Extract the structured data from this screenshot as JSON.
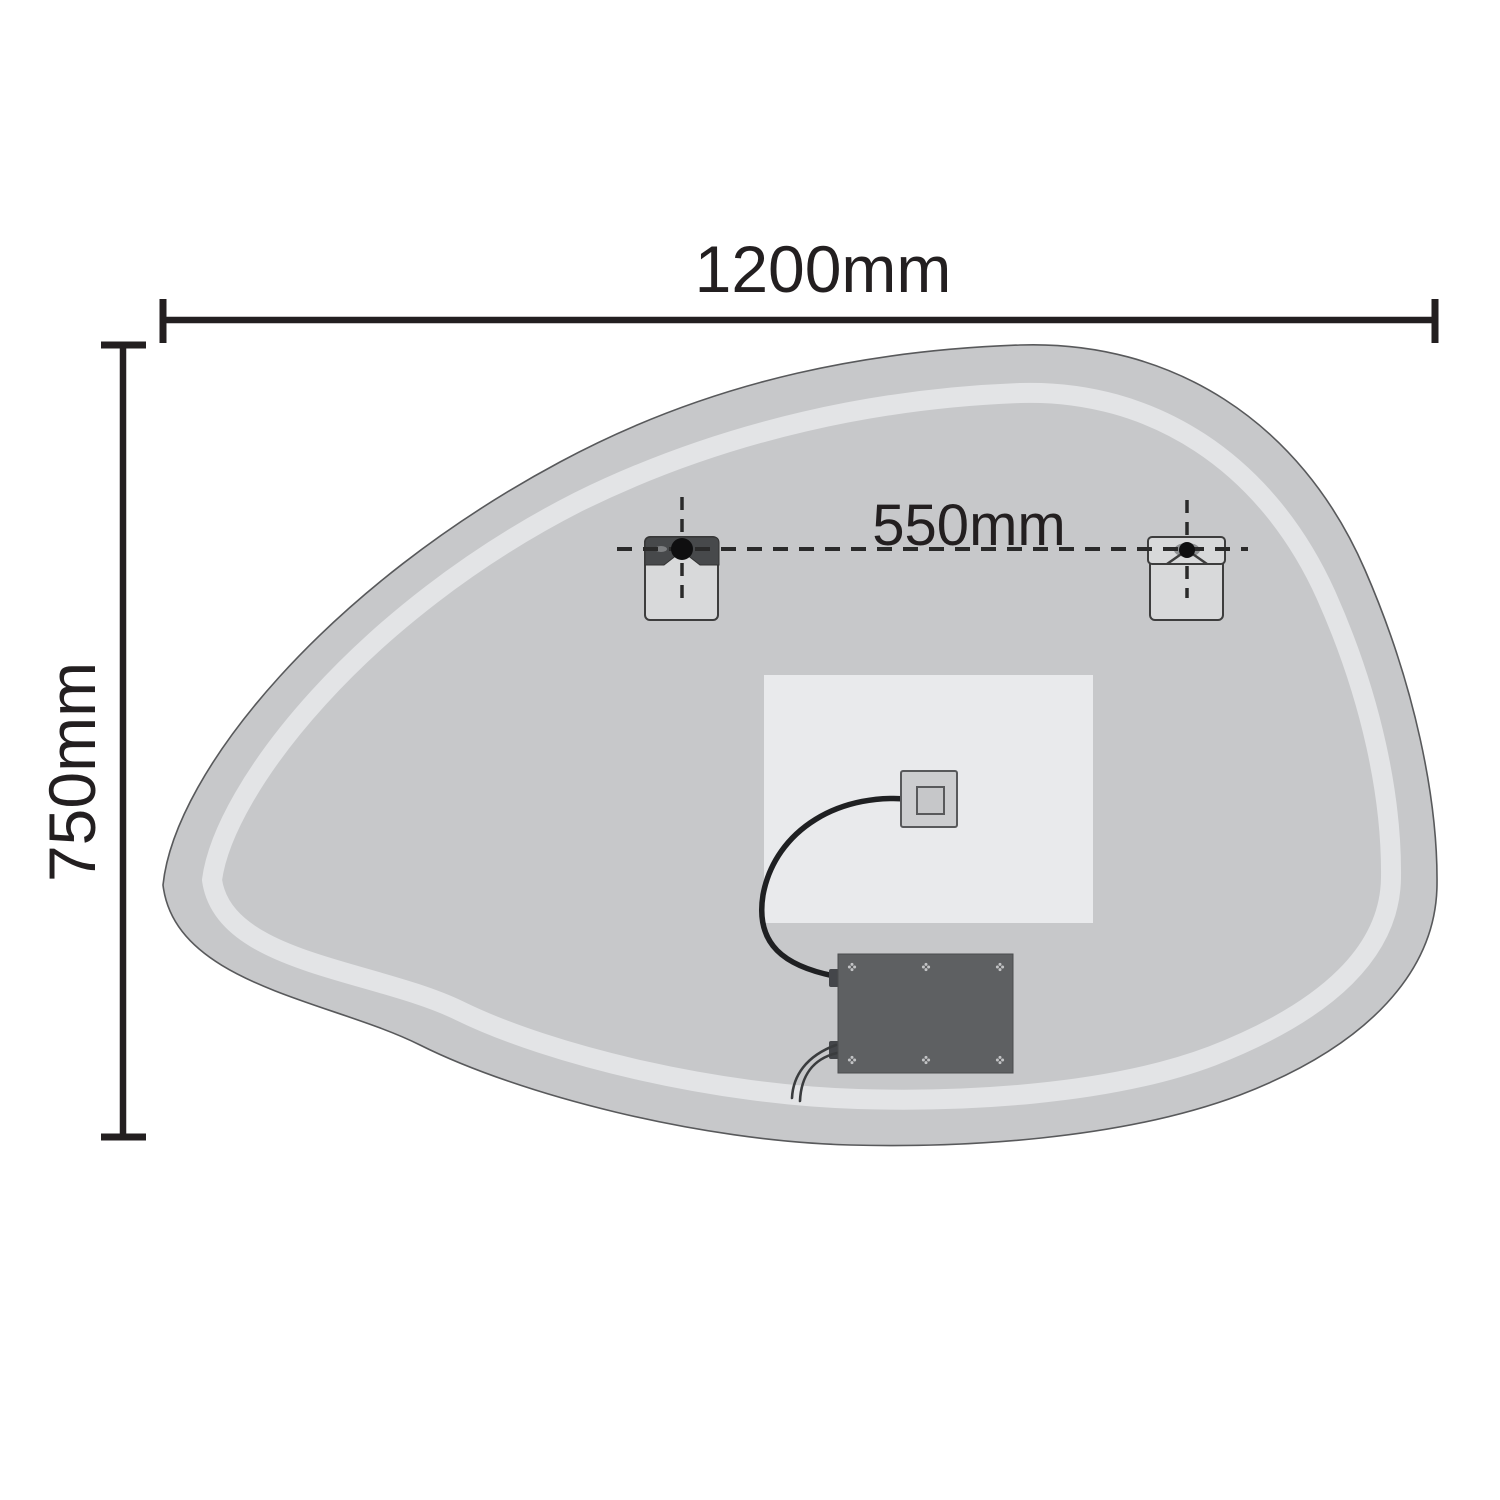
{
  "diagram": {
    "labels": {
      "overall_width": "1200mm",
      "overall_height": "750mm",
      "bracket_spacing": "550mm"
    },
    "colors": {
      "line": "#231f20",
      "dashed_line": "#2a2a2a",
      "mirror_fill": "#c7c8ca",
      "mirror_edge": "#58595b",
      "inner_band": "#e3e4e6",
      "backing_panel": "#e9eaec",
      "bracket_plate": "#d8d9da",
      "bracket_bar_dark": "#47494b",
      "bracket_pin": "#0f0f10",
      "junction_box": "#cccdcf",
      "junction_box_inner": "#c6c7c9",
      "driver_box": "#5e6062",
      "driver_screw": "#c2c3c5",
      "cable": "#1f2022",
      "wire": "#3a3c3e",
      "background": "#ffffff"
    }
  }
}
